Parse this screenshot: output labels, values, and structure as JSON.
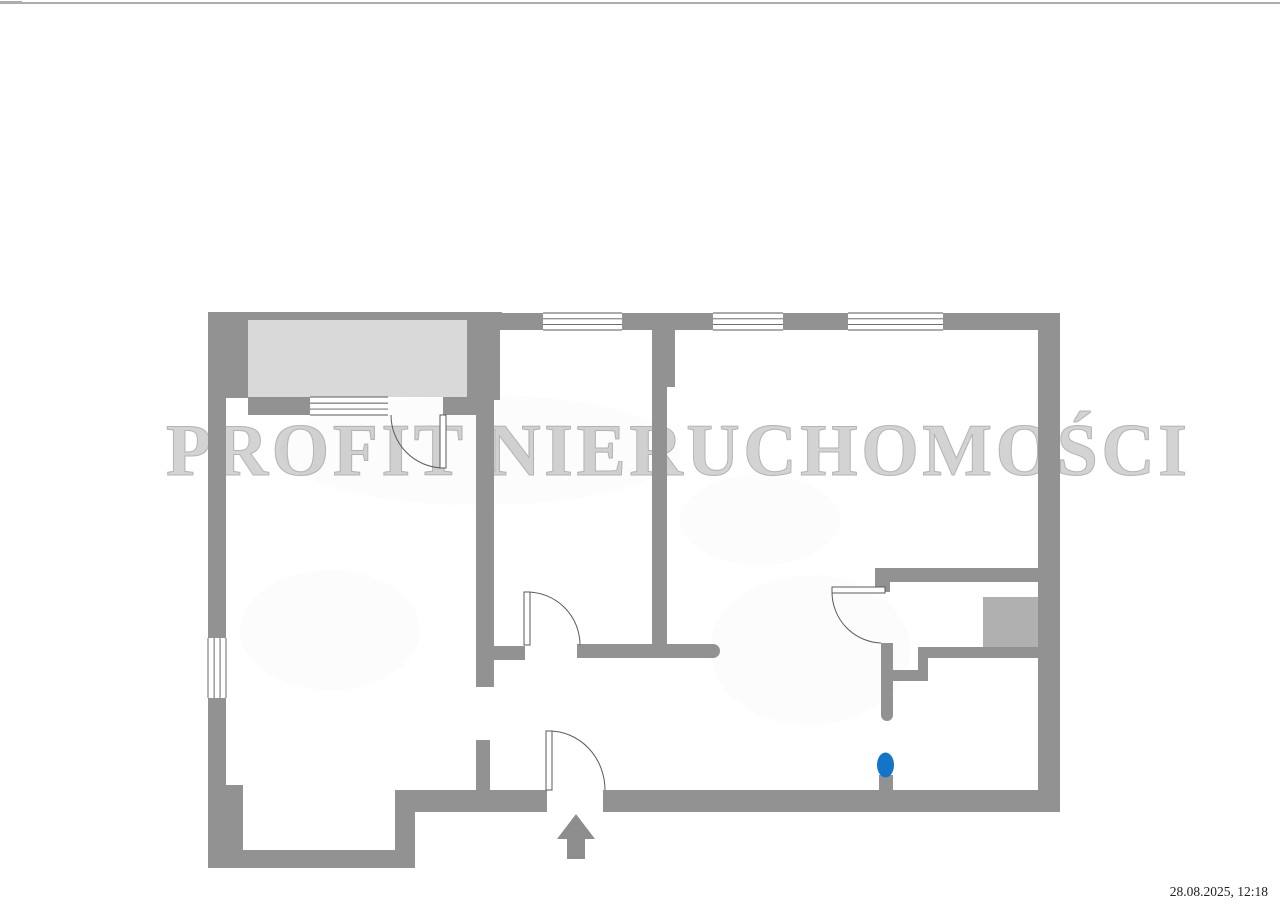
{
  "page": {
    "background": "#ffffff"
  },
  "watermark": {
    "text": "PROFIT NIERUCHOMOŚCI",
    "fill": "#d3d3d3",
    "outline": "#b5b5b5"
  },
  "timestamp": {
    "text": "28.08.2025, 12:18",
    "color": "#1f1f1f"
  },
  "plan": {
    "colors": {
      "wall": "#929292",
      "balcony": "#d9d9d9",
      "shaft": "#b0b0b0",
      "line": "#5a5a5a",
      "marker": "#1374c9",
      "arrow": "#8d8d8d",
      "scan_line": "#adadad"
    },
    "scan_artifacts": [
      {
        "x": 0,
        "y": 2,
        "w": 1280,
        "h": 2
      },
      {
        "x": 0,
        "y": 1,
        "w": 22,
        "h": 3
      }
    ],
    "shadows": [
      {
        "cx": 480,
        "cy": 450,
        "rx": 200,
        "ry": 55
      },
      {
        "cx": 810,
        "cy": 650,
        "rx": 100,
        "ry": 75
      },
      {
        "cx": 330,
        "cy": 630,
        "rx": 90,
        "ry": 60
      },
      {
        "cx": 760,
        "cy": 520,
        "rx": 80,
        "ry": 45
      }
    ],
    "fills": [
      {
        "name": "balcony-fill",
        "x": 248,
        "y": 320,
        "w": 219,
        "h": 77,
        "color": "balcony"
      },
      {
        "name": "shaft-fill",
        "x": 983,
        "y": 597,
        "w": 55,
        "h": 50,
        "color": "shaft"
      }
    ],
    "walls": [
      {
        "x": 208,
        "y": 312,
        "w": 294,
        "h": 8
      },
      {
        "x": 208,
        "y": 312,
        "w": 40,
        "h": 86
      },
      {
        "x": 467,
        "y": 313,
        "w": 76,
        "h": 17
      },
      {
        "x": 622,
        "y": 313,
        "w": 91,
        "h": 17
      },
      {
        "x": 783,
        "y": 313,
        "w": 65,
        "h": 17
      },
      {
        "x": 943,
        "y": 313,
        "w": 117,
        "h": 17
      },
      {
        "x": 1038,
        "y": 313,
        "w": 22,
        "h": 499
      },
      {
        "x": 208,
        "y": 398,
        "w": 18,
        "h": 240
      },
      {
        "x": 208,
        "y": 698,
        "w": 18,
        "h": 152
      },
      {
        "x": 226,
        "y": 785,
        "w": 17,
        "h": 65
      },
      {
        "x": 208,
        "y": 850,
        "w": 207,
        "h": 18
      },
      {
        "x": 395,
        "y": 790,
        "w": 20,
        "h": 78
      },
      {
        "x": 395,
        "y": 790,
        "w": 152,
        "h": 22
      },
      {
        "x": 603,
        "y": 790,
        "w": 457,
        "h": 22
      },
      {
        "x": 248,
        "y": 397,
        "w": 62,
        "h": 18
      },
      {
        "x": 443,
        "y": 397,
        "w": 34,
        "h": 18
      },
      {
        "x": 467,
        "y": 313,
        "w": 33,
        "h": 87
      },
      {
        "x": 476,
        "y": 398,
        "w": 18,
        "h": 289
      },
      {
        "x": 476,
        "y": 740,
        "w": 14,
        "h": 50
      },
      {
        "x": 477,
        "y": 646,
        "w": 48,
        "h": 14
      },
      {
        "x": 577,
        "y": 644,
        "w": 136,
        "h": 14,
        "cap": "right"
      },
      {
        "x": 652,
        "y": 330,
        "w": 23,
        "h": 57
      },
      {
        "x": 652,
        "y": 387,
        "w": 15,
        "h": 271
      },
      {
        "x": 875,
        "y": 568,
        "w": 185,
        "h": 14
      },
      {
        "x": 875,
        "y": 582,
        "w": 15,
        "h": 10
      },
      {
        "x": 881,
        "y": 643,
        "w": 12,
        "h": 72,
        "cap": "bottom"
      },
      {
        "x": 893,
        "y": 670,
        "w": 35,
        "h": 11
      },
      {
        "x": 918,
        "y": 647,
        "w": 10,
        "h": 23
      },
      {
        "x": 918,
        "y": 647,
        "w": 142,
        "h": 11
      },
      {
        "x": 879,
        "y": 775,
        "w": 14,
        "h": 16
      }
    ],
    "windows": [
      {
        "x": 543,
        "y": 313,
        "w": 79,
        "h": 17,
        "dir": "h"
      },
      {
        "x": 713,
        "y": 313,
        "w": 70,
        "h": 17,
        "dir": "h"
      },
      {
        "x": 848,
        "y": 313,
        "w": 95,
        "h": 17,
        "dir": "h"
      },
      {
        "x": 310,
        "y": 397,
        "w": 78,
        "h": 18,
        "dir": "h"
      },
      {
        "x": 208,
        "y": 638,
        "w": 18,
        "h": 60,
        "dir": "v"
      }
    ],
    "doors": [
      {
        "name": "balcony-door",
        "leaf": {
          "x": 440,
          "y": 415,
          "w": 6,
          "h": 53
        },
        "arc": "M391 415 A53 53 0 0 0 443 468"
      },
      {
        "name": "room-door",
        "leaf": {
          "x": 524,
          "y": 592,
          "w": 6,
          "h": 53
        },
        "arc": "M527 592 A53 53 0 0 1 580 645"
      },
      {
        "name": "bathroom-door",
        "leaf": {
          "x": 832,
          "y": 587,
          "w": 53,
          "h": 6
        },
        "arc": "M832 592 A51 51 0 0 0 881 643"
      },
      {
        "name": "entrance-door",
        "leaf": {
          "x": 546,
          "y": 731,
          "w": 6,
          "h": 59
        },
        "arc": "M549 731 A56 59 0 0 1 605 790"
      }
    ],
    "entrance_arrow": {
      "points": "576,814 595,839 585,839 585,859 567,859 567,839 557,839"
    },
    "marker": {
      "cx": 885.5,
      "cy": 765,
      "rx": 8.5,
      "ry": 12.5
    }
  }
}
